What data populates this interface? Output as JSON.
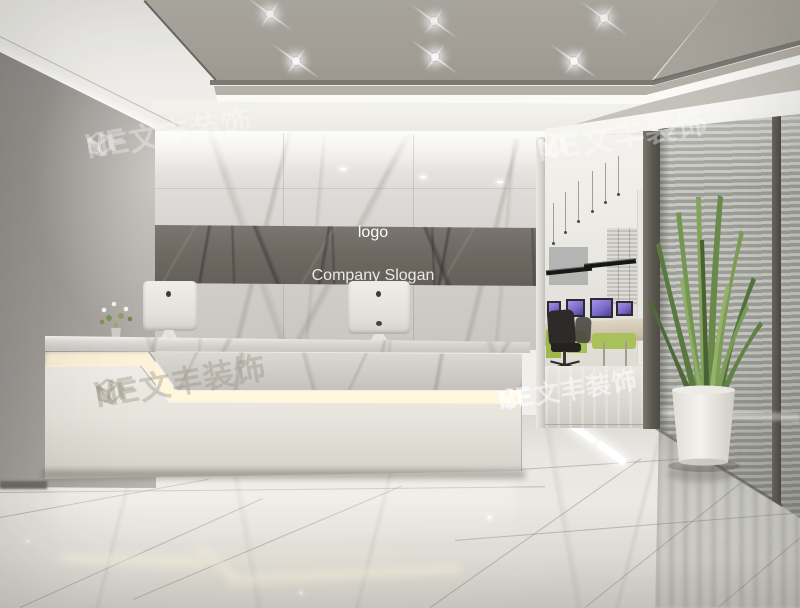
{
  "signage": {
    "logo": "logo",
    "slogan": "Company Slogan"
  },
  "watermark": {
    "prefix": "VF",
    "cube_icon": "hexagon-cube-logo",
    "suffix": "NE文丰装饰"
  },
  "colors": {
    "led-warm": "#fff6dc",
    "lime-green": "#a7bf55",
    "screen-purple": "#8b7bd6",
    "plant-green": "#6f9048",
    "band-gray": "#6e6962",
    "marble-light": "#e9e7e3",
    "ceiling-tray": "#aba79f"
  }
}
